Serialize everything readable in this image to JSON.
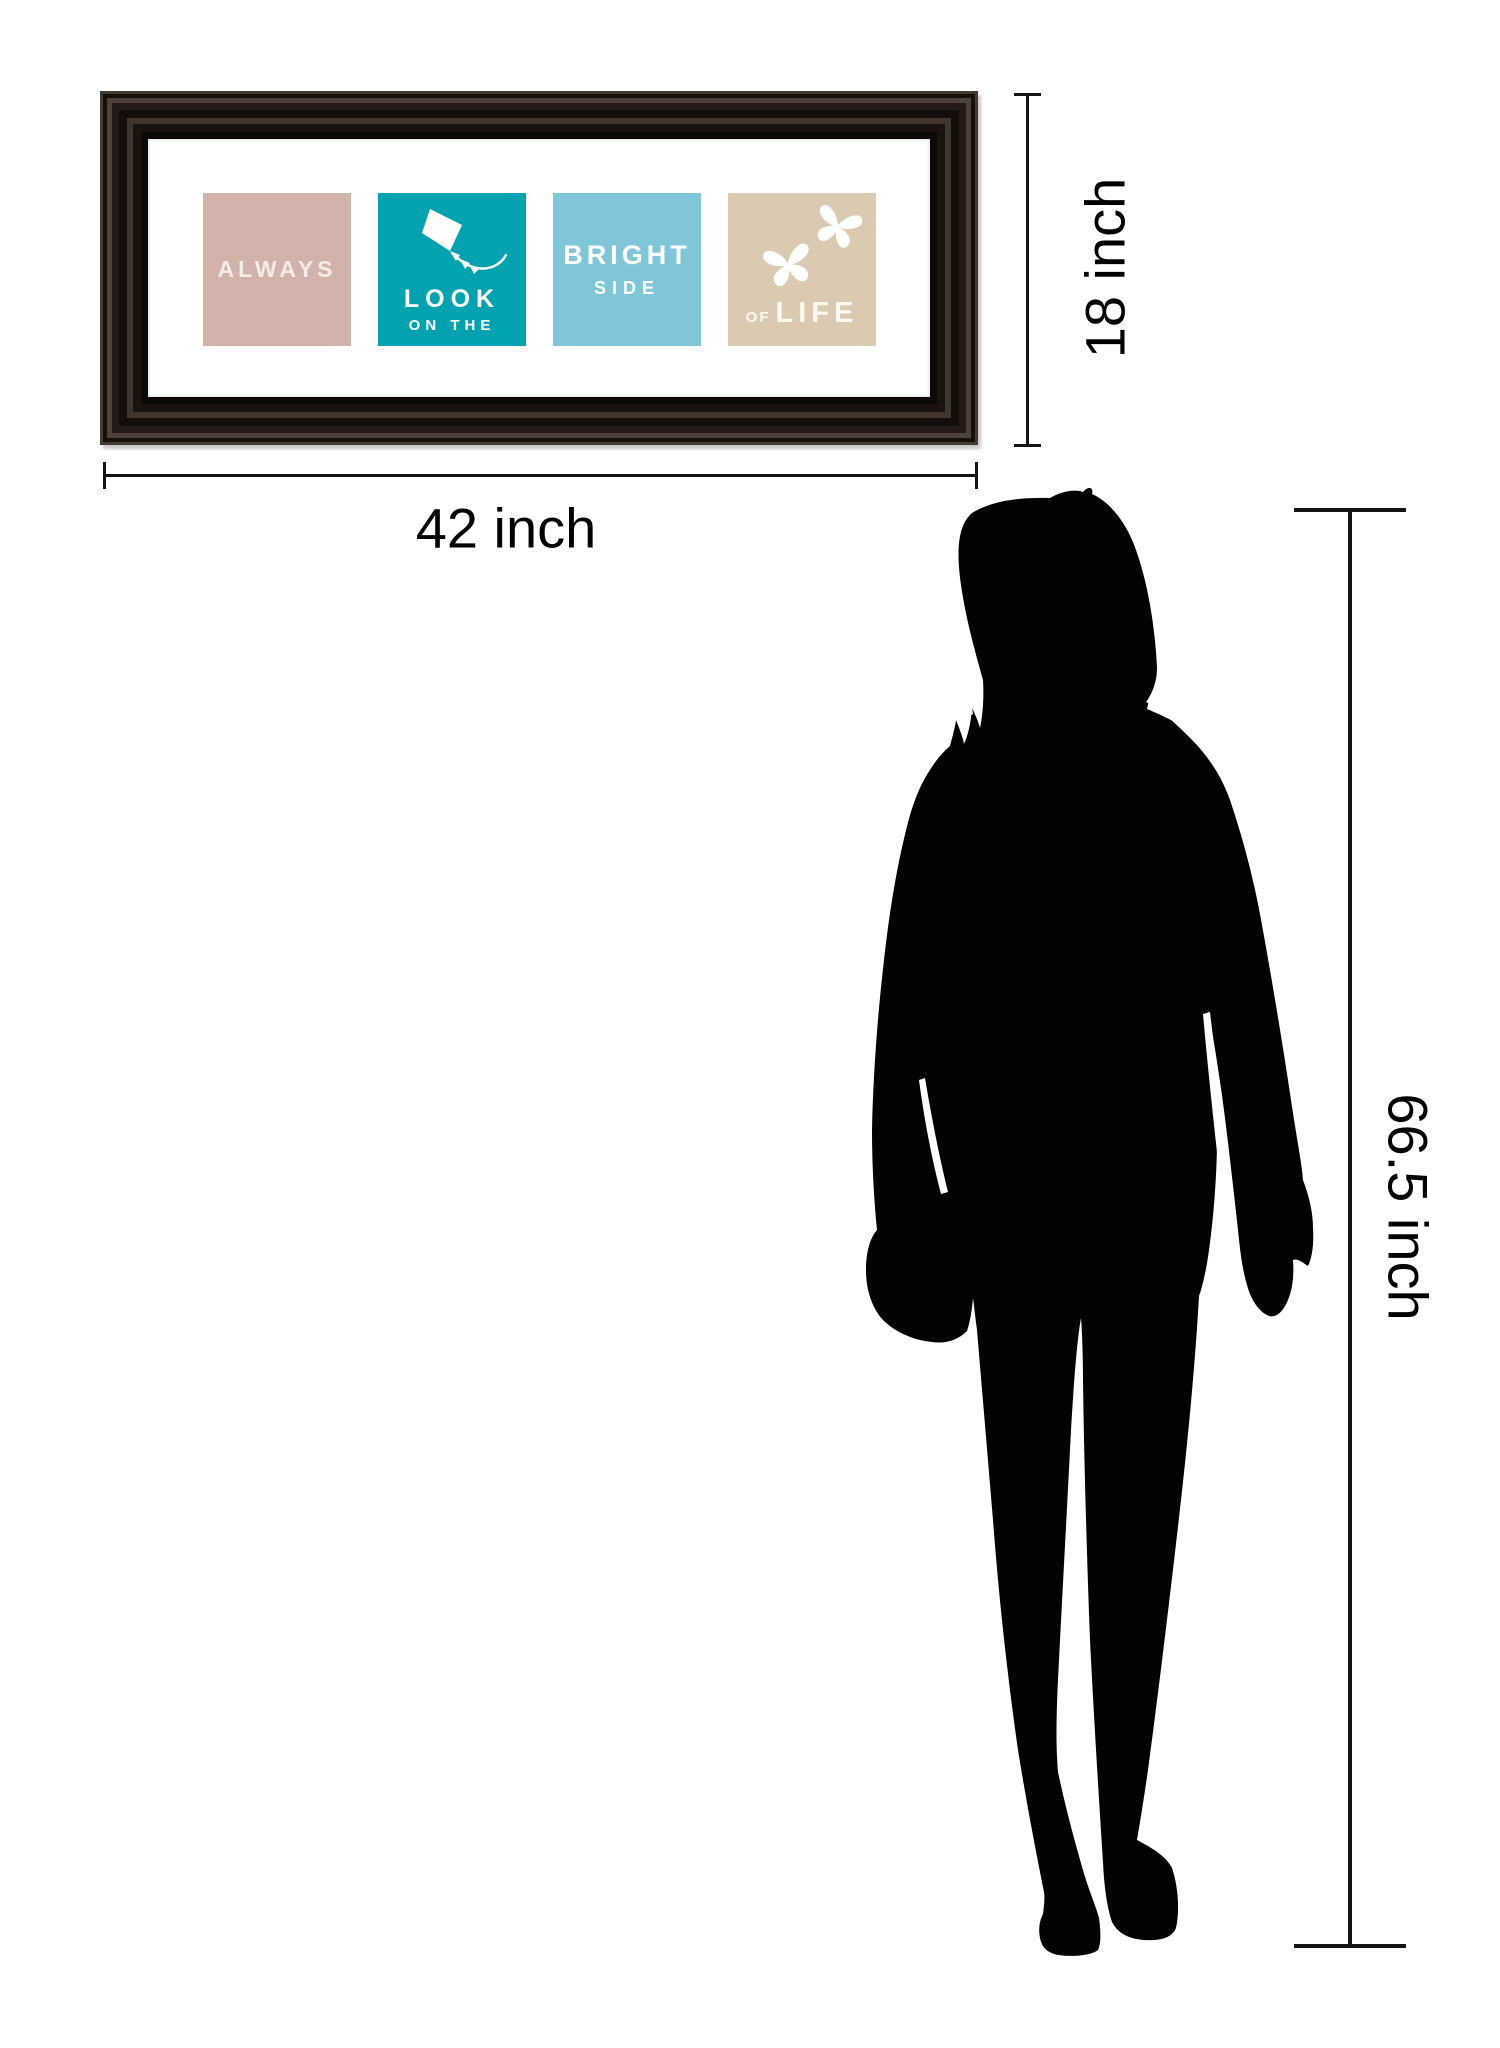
{
  "artwork": {
    "title": "Always Look On The Bright Side Of Life framed wall art",
    "frame_color": "#1f1714",
    "mat_color": "#ffffff",
    "panels": [
      {
        "bg_color": "#d2b3ab",
        "text_color": "#f5ece6",
        "icon": null,
        "words": [
          "ALWAYS"
        ]
      },
      {
        "bg_color": "#02a2b1",
        "text_color": "#ffffff",
        "icon": "kite-icon",
        "words": [
          "LOOK",
          "ON THE"
        ]
      },
      {
        "bg_color": "#7ec6d8",
        "text_color": "#ffffff",
        "icon": null,
        "words": [
          "BRIGHT",
          "SIDE"
        ]
      },
      {
        "bg_color": "#d9cab1",
        "text_color": "#fdf8ef",
        "icon": "butterflies-icon",
        "words": [
          "OF",
          "LIFE"
        ]
      }
    ]
  },
  "dimensions": {
    "frame_width": {
      "label": "42 inch"
    },
    "frame_height": {
      "label": "18 inch"
    },
    "person_height": {
      "label": "66.5 inch"
    }
  },
  "figure": {
    "name": "woman-silhouette",
    "color": "#030303"
  },
  "line_color": "#141414"
}
